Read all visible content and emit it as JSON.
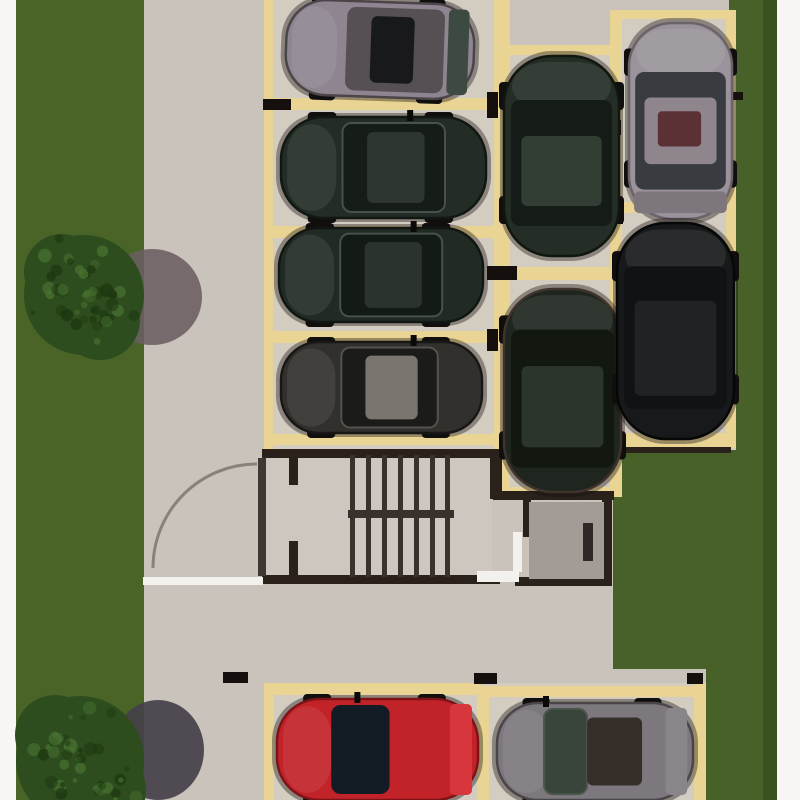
{
  "meta": {
    "type": "architectural-site-plan-rendering",
    "subject": "top-down 3D rendering of a residential parking lot with parked cars, stairwell block, lawn strips and trees",
    "canvas_width": 800,
    "canvas_height": 800
  },
  "palette": {
    "page": "#f7f6f4",
    "pavement": "#c9c3bc",
    "spaceFloor": "#d3ccc1",
    "stairFloor": "#cdc7c0",
    "grassL": "#4a6427",
    "grassR": "#486129",
    "grassDark": "#3a5120",
    "tan": "#e9d494",
    "wall": "#2a211b",
    "tread": "#39322c",
    "curb": "#f3f1ed",
    "roomFloor": "#a29b96",
    "roomDoor": "#2e2926",
    "stop": "#15100d",
    "leaf": "#3e3833",
    "arc": "#8a8178",
    "shadow1": "#6a5d62",
    "shadow2": "#454049",
    "treeBase": "#2e4d1e",
    "speckDark": "#1c3710",
    "speckLight": "#477030"
  },
  "regions": [
    {
      "n": "pavement-base",
      "x": 0,
      "y": 0,
      "w": 800,
      "h": 800,
      "c": "pavement"
    },
    {
      "n": "lawn-left",
      "x": 16,
      "y": 0,
      "w": 128,
      "h": 800,
      "c": "grassL"
    },
    {
      "n": "lawn-right-strip",
      "x": 729,
      "y": 0,
      "w": 48,
      "h": 800,
      "c": "grassR"
    },
    {
      "n": "lawn-right-block",
      "x": 613,
      "y": 450,
      "w": 164,
      "h": 219,
      "c": "grassR"
    },
    {
      "n": "lawn-bottom-right",
      "x": 706,
      "y": 669,
      "w": 71,
      "h": 131,
      "c": "grassR"
    },
    {
      "n": "lawn-right-dark-edge",
      "x": 763,
      "y": 0,
      "w": 14,
      "h": 800,
      "c": "grassDark"
    },
    {
      "n": "margin-left",
      "x": 0,
      "y": 0,
      "w": 16,
      "h": 800,
      "c": "page"
    },
    {
      "n": "margin-right",
      "x": 777,
      "y": 0,
      "w": 23,
      "h": 800,
      "c": "page"
    },
    {
      "n": "stalls-left-floor",
      "x": 265,
      "y": 0,
      "w": 237,
      "h": 450,
      "c": "spaceFloor"
    },
    {
      "n": "stalls-middle-floor",
      "x": 497,
      "y": 45,
      "w": 125,
      "h": 452,
      "c": "spaceFloor"
    },
    {
      "n": "stalls-right-floor",
      "x": 610,
      "y": 10,
      "w": 126,
      "h": 440,
      "c": "spaceFloor"
    },
    {
      "n": "stalls-bottom-floor",
      "x": 264,
      "y": 683,
      "w": 441,
      "h": 117,
      "c": "spaceFloor"
    },
    {
      "n": "stairwell-floor",
      "x": 266,
      "y": 455,
      "w": 226,
      "h": 122,
      "c": "stairFloor"
    }
  ],
  "space_lines": [
    {
      "n": "stall-line-left-vertical",
      "x": 264,
      "y": 0,
      "w": 9,
      "h": 452
    },
    {
      "n": "stall-line-shared-vertical",
      "x": 494,
      "y": 0,
      "w": 16,
      "h": 497
    },
    {
      "n": "stall-line-row0-bottom",
      "x": 266,
      "y": 98,
      "w": 230,
      "h": 12
    },
    {
      "n": "stall-line-row1-bottom",
      "x": 266,
      "y": 226,
      "w": 230,
      "h": 12
    },
    {
      "n": "stall-line-row2-bottom",
      "x": 266,
      "y": 331,
      "w": 230,
      "h": 12
    },
    {
      "n": "stall-line-row3-bottom",
      "x": 266,
      "y": 434,
      "w": 230,
      "h": 11
    },
    {
      "n": "stall-line-mid-right-vertical",
      "x": 610,
      "y": 10,
      "w": 12,
      "h": 487
    },
    {
      "n": "stall-line-m1-top",
      "x": 497,
      "y": 45,
      "w": 115,
      "h": 10
    },
    {
      "n": "stall-line-m-divider",
      "x": 497,
      "y": 267,
      "w": 115,
      "h": 13
    },
    {
      "n": "stall-line-m2-bottom",
      "x": 497,
      "y": 487,
      "w": 117,
      "h": 10
    },
    {
      "n": "stall-line-r1-top",
      "x": 610,
      "y": 10,
      "w": 126,
      "h": 9
    },
    {
      "n": "stall-line-right-vertical",
      "x": 726,
      "y": 10,
      "w": 10,
      "h": 438
    },
    {
      "n": "stall-line-r-divider",
      "x": 613,
      "y": 202,
      "w": 122,
      "h": 11
    },
    {
      "n": "stall-line-r2-bottom",
      "x": 613,
      "y": 433,
      "w": 119,
      "h": 14
    },
    {
      "n": "stall-line-bottom-left-vertical",
      "x": 264,
      "y": 683,
      "w": 10,
      "h": 117
    },
    {
      "n": "stall-line-bottom-divider",
      "x": 477,
      "y": 686,
      "w": 12,
      "h": 114
    },
    {
      "n": "stall-line-bottom-right-vertical",
      "x": 694,
      "y": 683,
      "w": 12,
      "h": 117
    },
    {
      "n": "stall-line-red-top",
      "x": 264,
      "y": 683,
      "w": 217,
      "h": 12
    },
    {
      "n": "stall-line-gray-top",
      "x": 480,
      "y": 686,
      "w": 225,
      "h": 11
    }
  ],
  "walls": [
    {
      "n": "stair-wall-top",
      "x": 262,
      "y": 449,
      "w": 238,
      "h": 9
    },
    {
      "n": "stair-wall-bottom",
      "x": 262,
      "y": 575,
      "w": 238,
      "h": 9
    },
    {
      "n": "stair-wall-right",
      "x": 490,
      "y": 449,
      "w": 12,
      "h": 50
    },
    {
      "n": "room-wall-top",
      "x": 493,
      "y": 491,
      "w": 121,
      "h": 9
    },
    {
      "n": "room-wall-left",
      "x": 523,
      "y": 499,
      "w": 8,
      "h": 38
    },
    {
      "n": "room-wall-right",
      "x": 602,
      "y": 500,
      "w": 10,
      "h": 86
    },
    {
      "n": "room-wall-bottom",
      "x": 515,
      "y": 577,
      "w": 97,
      "h": 9
    },
    {
      "n": "lawn-edge-line",
      "x": 617,
      "y": 447,
      "w": 114,
      "h": 6
    }
  ],
  "curbs": [
    {
      "n": "curb-aisle",
      "x": 143,
      "y": 577,
      "w": 120,
      "h": 8
    },
    {
      "n": "curb-stair-south",
      "x": 477,
      "y": 571,
      "w": 42,
      "h": 11
    },
    {
      "n": "curb-room-west",
      "x": 513,
      "y": 532,
      "w": 9,
      "h": 40
    }
  ],
  "wheel_stops": [
    {
      "n": "wheel-stop",
      "x": 263,
      "y": 99,
      "w": 28,
      "h": 11
    },
    {
      "n": "wheel-stop",
      "x": 487,
      "y": 92,
      "w": 11,
      "h": 26
    },
    {
      "n": "wheel-stop",
      "x": 487,
      "y": 266,
      "w": 30,
      "h": 14
    },
    {
      "n": "wheel-stop",
      "x": 487,
      "y": 329,
      "w": 11,
      "h": 22
    },
    {
      "n": "wheel-stop",
      "x": 612,
      "y": 120,
      "w": 9,
      "h": 15
    },
    {
      "n": "wheel-stop",
      "x": 612,
      "y": 205,
      "w": 11,
      "h": 19
    },
    {
      "n": "wheel-stop",
      "x": 612,
      "y": 350,
      "w": 10,
      "h": 22
    },
    {
      "n": "wheel-stop",
      "x": 223,
      "y": 672,
      "w": 25,
      "h": 11
    },
    {
      "n": "wheel-stop",
      "x": 474,
      "y": 673,
      "w": 23,
      "h": 11
    },
    {
      "n": "wheel-stop",
      "x": 687,
      "y": 673,
      "w": 16,
      "h": 11
    },
    {
      "n": "lawn-marker",
      "x": 731,
      "y": 92,
      "w": 12,
      "h": 8
    }
  ],
  "stairs": {
    "tread_xs": [
      350,
      366,
      382,
      398,
      414,
      430,
      445
    ],
    "tread_y": 455,
    "tread_w": 5,
    "tread_h": 122,
    "rail": {
      "x": 348,
      "y": 510,
      "w": 106,
      "h": 8
    }
  },
  "door": {
    "arc": {
      "cx": 257,
      "cy": 568,
      "r": 104,
      "start_x": 153,
      "start_y": 568,
      "end_x": 257,
      "end_y": 464
    },
    "leaf": {
      "x": 258,
      "y": 458,
      "w": 8,
      "h": 118
    },
    "jambs": [
      {
        "n": "door-jamb-top",
        "x": 289,
        "y": 455,
        "w": 9,
        "h": 30
      },
      {
        "n": "door-jamb-bottom",
        "x": 289,
        "y": 541,
        "w": 9,
        "h": 43
      }
    ]
  },
  "room": {
    "floor": {
      "x": 529,
      "y": 502,
      "w": 75,
      "h": 77
    },
    "door_bar": {
      "x": 583,
      "y": 523,
      "w": 10,
      "h": 38
    }
  },
  "trees": [
    {
      "n": "tree-upper-left",
      "seed": 7,
      "shadow": {
        "cx": 152,
        "cy": 297,
        "rx": 50,
        "ry": 48,
        "c": "shadow1",
        "opacity": 0.88
      },
      "blobs": [
        {
          "cx": 84,
          "cy": 295,
          "r": 60
        },
        {
          "cx": 62,
          "cy": 272,
          "r": 38
        },
        {
          "cx": 100,
          "cy": 320,
          "r": 40
        }
      ]
    },
    {
      "n": "tree-lower-left",
      "seed": 13,
      "shadow": {
        "cx": 158,
        "cy": 750,
        "rx": 46,
        "ry": 50,
        "c": "shadow2",
        "opacity": 0.92
      },
      "blobs": [
        {
          "cx": 80,
          "cy": 760,
          "r": 64
        },
        {
          "cx": 55,
          "cy": 735,
          "r": 40
        },
        {
          "cx": 100,
          "cy": 790,
          "r": 46
        }
      ]
    }
  ],
  "cars": [
    {
      "name": "car-gray-top-left",
      "x": 286,
      "y": 2,
      "w": 188,
      "h": 95,
      "dir": "h",
      "tilt": 2,
      "body": "#8e8590",
      "edge": "#4b4549",
      "glass": "#565055",
      "roof": "#17191b",
      "rear": "#3d4a42",
      "gs": 0.32,
      "ge": 0.84,
      "rs": 0.45,
      "re": 0.68,
      "antenna": false
    },
    {
      "name": "car-dark-row1",
      "x": 281,
      "y": 117,
      "w": 205,
      "h": 101,
      "dir": "h",
      "body": "#232c25",
      "edge": "#121713",
      "glass": "#161c17",
      "roof": "#2d372f",
      "trim": "#46524a",
      "gs": 0.3,
      "ge": 0.8,
      "rs": 0.42,
      "re": 0.7,
      "antenna": true,
      "antenna_pos": 0.63
    },
    {
      "name": "car-dark-row2",
      "x": 279,
      "y": 228,
      "w": 204,
      "h": 94,
      "dir": "h",
      "body": "#212b24",
      "edge": "#111612",
      "glass": "#141a15",
      "roof": "#2a342c",
      "trim": "#46524a",
      "gs": 0.3,
      "ge": 0.8,
      "rs": 0.42,
      "re": 0.7,
      "antenna": true,
      "antenna_pos": 0.66
    },
    {
      "name": "car-dark-row3",
      "x": 281,
      "y": 342,
      "w": 201,
      "h": 91,
      "dir": "h",
      "body": "#31302d",
      "edge": "#191715",
      "glass": "#1b1b19",
      "roof": "#7b7570",
      "trim": "#55514c",
      "gs": 0.3,
      "ge": 0.78,
      "rs": 0.42,
      "re": 0.68,
      "antenna": true,
      "antenna_pos": 0.66
    },
    {
      "name": "suv-dark-upper",
      "x": 504,
      "y": 56,
      "w": 115,
      "h": 200,
      "dir": "v",
      "body": "#242d26",
      "edge": "#11160f",
      "glass": "#151b16",
      "roof": "#323d34",
      "gs": 0.22,
      "ge": 0.85,
      "rs": 0.4,
      "re": 0.75,
      "antenna": false
    },
    {
      "name": "suv-dark-lower",
      "x": 504,
      "y": 289,
      "w": 117,
      "h": 203,
      "dir": "v",
      "body": "#1f261f",
      "edge": "#3f332c",
      "glass": "#12170f",
      "roof": "#2c352b",
      "gs": 0.2,
      "ge": 0.88,
      "rs": 0.38,
      "re": 0.78,
      "antenna": false
    },
    {
      "name": "car-silver-top-right",
      "x": 629,
      "y": 23,
      "w": 103,
      "h": 196,
      "dir": "v",
      "body": "#9a939b",
      "edge": "#6a6369",
      "glass": "#383b40",
      "roof": "#8e868c",
      "rear": "#7d767c",
      "accent": {
        "pos": 0.45,
        "len": 0.18,
        "color": "#5c3136"
      },
      "gs": 0.25,
      "ge": 0.85,
      "rs": 0.38,
      "re": 0.72,
      "antenna": false
    },
    {
      "name": "suv-black-right",
      "x": 617,
      "y": 223,
      "w": 117,
      "h": 216,
      "dir": "v",
      "body": "#17191b",
      "edge": "#060707",
      "glass": "#101214",
      "roof": "#202326",
      "gs": 0.2,
      "ge": 0.86,
      "rs": 0.36,
      "re": 0.8,
      "antenna": false
    },
    {
      "name": "car-red-bottom",
      "x": 277,
      "y": 699,
      "w": 201,
      "h": 101,
      "dir": "h",
      "body": "#c22329",
      "edge": "#7e1317",
      "glass": "#131b25",
      "rear": "#d6363c",
      "gs": 0.27,
      "ge": 0.56,
      "rs": 0,
      "re": 0,
      "antenna": true,
      "antenna_pos": 0.4
    },
    {
      "name": "car-gray-bottom",
      "x": 497,
      "y": 703,
      "w": 196,
      "h": 97,
      "dir": "h",
      "body": "#7d787e",
      "edge": "#4a4549",
      "glass": "#39453b",
      "roof": "#352e29",
      "trim": "#4b574c",
      "rear": "#8a858b",
      "gs": 0.24,
      "ge": 0.46,
      "rs": 0.46,
      "re": 0.74,
      "antenna": true,
      "antenna_pos": 0.25
    }
  ]
}
